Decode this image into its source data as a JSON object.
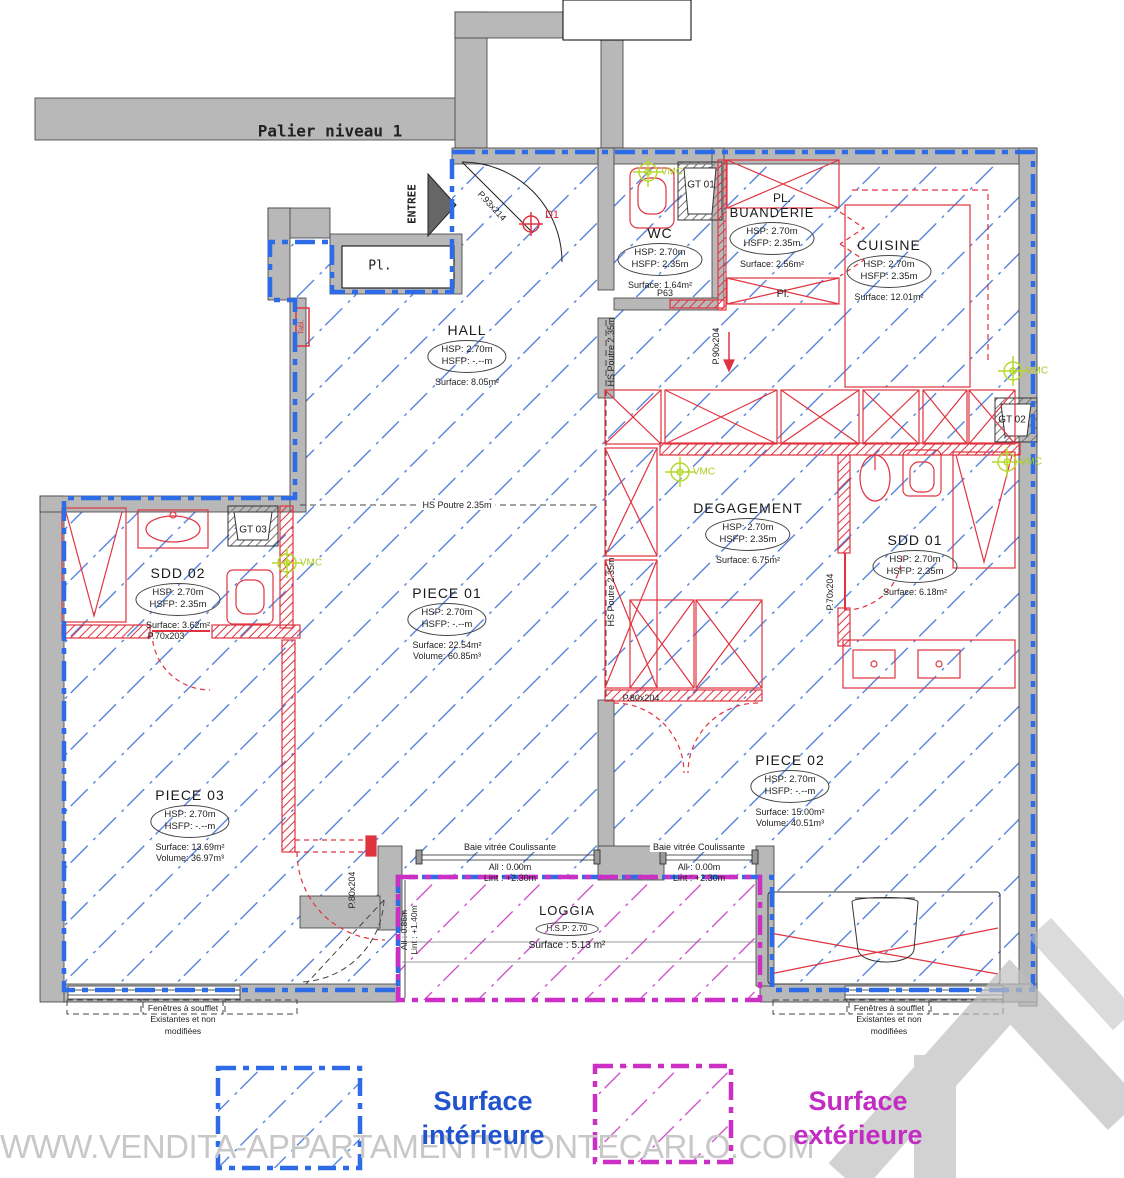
{
  "title": "Palier niveau 1",
  "watermark": "WWW.VENDITA-APPARTAMENTI-MONTECARLO.COM",
  "legend": {
    "interior": "Surface intérieure",
    "exterior": "Surface extérieure"
  },
  "colors": {
    "interior_line": "#2e6be6",
    "exterior_line": "#cb2fc4",
    "wall_gray": "#b8b8b8",
    "fixture_red": "#e03340",
    "hatch_blue": "#4273d6",
    "vmc_green": "#aacc22",
    "watermark_gray": "#c8c8c8"
  },
  "entry": {
    "label": "ENTREE",
    "closet": "Pl.",
    "marker_d1": "D1"
  },
  "rooms": [
    {
      "name": "HALL",
      "hsp": "HSP: 2.70m",
      "hsfp": "HSFP: -.--m",
      "surface": "Surface: 8.05m²"
    },
    {
      "name": "WC",
      "hsp": "HSP: 2.70m",
      "hsfp": "HSFP: 2.35m",
      "surface": "Surface: 1.64m²"
    },
    {
      "name": "BUANDERIE",
      "hsp": "HSP: 2.70m",
      "hsfp": "HSFP: 2.35m",
      "surface": "Surface: 2.56m²"
    },
    {
      "name": "CUISINE",
      "hsp": "HSP: 2.70m",
      "hsfp": "HSFP: 2.35m",
      "surface": "Surface: 12.01m²"
    },
    {
      "name": "SDD 02",
      "hsp": "HSP: 2.70m",
      "hsfp": "HSFP: 2.35m",
      "surface": "Surface: 3.62m²"
    },
    {
      "name": "PIECE 01",
      "hsp": "HSP: 2.70m",
      "hsfp": "HSFP: -.--m",
      "surface": "Surface: 22.54m²",
      "volume": "Volume: 60.85m³"
    },
    {
      "name": "DEGAGEMENT",
      "hsp": "HSP: 2.70m",
      "hsfp": "HSFP: 2.35m",
      "surface": "Surface: 6.75m²"
    },
    {
      "name": "SDD 01",
      "hsp": "HSP: 2.70m",
      "hsfp": "HSFP: 2.35m",
      "surface": "Surface: 6.18m²"
    },
    {
      "name": "PIECE 03",
      "hsp": "HSP: 2.70m",
      "hsfp": "HSFP: -.--m",
      "surface": "Surface: 13.69m²",
      "volume": "Volume: 36.97m³"
    },
    {
      "name": "PIECE 02",
      "hsp": "HSP: 2.70m",
      "hsfp": "HSFP: -.--m",
      "surface": "Surface: 15.00m²",
      "volume": "Volume: 40.51m³"
    },
    {
      "name": "LOGGIA",
      "hsp": "H.S.P: 2.70",
      "surface": "Surface : 5.13 m²"
    }
  ],
  "closets": {
    "pl_upper": "PL.",
    "pl_lower": "Pl."
  },
  "vents": {
    "gt01": "GT 01",
    "gt02": "GT 02",
    "gt03": "GT 03",
    "vmc": "VMC"
  },
  "doors": {
    "entry": "P.93x214",
    "p63": "P63",
    "p90": "P.90x204",
    "p70_203": "P.70x203",
    "p70_204": "P.70x204",
    "p80_a": "P.80x204",
    "p80_b": "P.80x204"
  },
  "beams": {
    "hs": "HS Poutre 2.35m"
  },
  "windows": {
    "baie": {
      "name": "Baie vitrée Coulissante",
      "all": "All : 0.00m",
      "lint": "Lint : +2.30m"
    },
    "rail": {
      "all": "All : 0.86m",
      "lint": "Lint : +1.40m"
    }
  },
  "notes": {
    "soufflet_l1": "Fenêtres à soufflet",
    "soufflet_l2": "Existantes et non",
    "soufflet_l3": "modifiées",
    "tabl": "Tabl."
  }
}
